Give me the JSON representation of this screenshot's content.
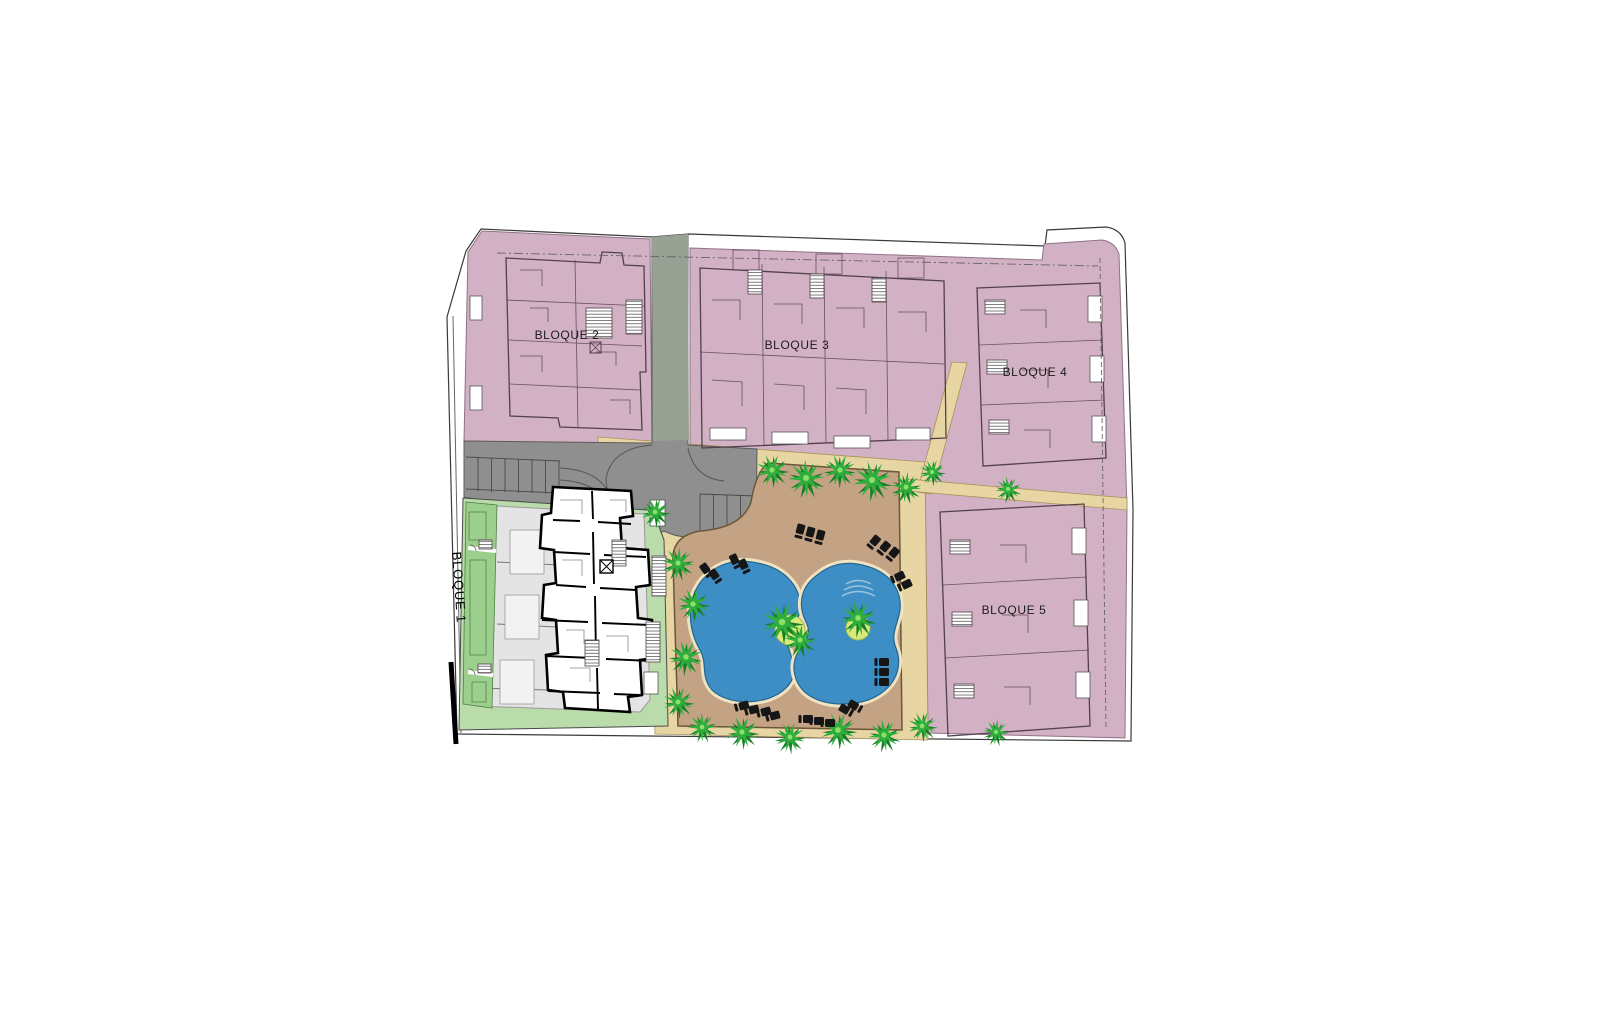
{
  "document": {
    "kind": "architectural-site-plan",
    "background": "#ffffff"
  },
  "labels": {
    "bloque1": "BLOQUE 1",
    "bloque2": "BLOQUE 2",
    "bloque3": "BLOQUE 3",
    "bloque4": "BLOQUE 4",
    "bloque5": "BLOQUE 5"
  },
  "features": {
    "pools": 2,
    "icon_names": [
      "palm-tree-icon",
      "sun-lounger-icon",
      "stair-hatch-icon",
      "elevator-x-icon"
    ],
    "areas": [
      "pink residential parcels",
      "gray road and parking",
      "sand pedestrian paths",
      "pool deck garden",
      "green private gardens",
      "white Bloque 1 floor plan"
    ]
  },
  "palette": {
    "parcel-pink": "#d3b1c4",
    "parcel-outline": "#8f7286",
    "plan-line": "#53404d",
    "road-gray": "#8f8f8f",
    "road-sage": "#97a294",
    "road-edge": "#5c5c5c",
    "sand": "#e7d6a4",
    "sand-edge": "#a89258",
    "deck": "#c3a384",
    "deck-edge": "#6b5738",
    "pool-blue": "#3c8ec4",
    "pool-edge": "#23658f",
    "pool-rim": "#efe3c2",
    "lawn": "#b9dcaa",
    "plot-green": "#9ccf8d",
    "plot-edge": "#4f7f42",
    "terrace": "#e4e4e4",
    "terrace-edge": "#9a9a9a",
    "tree-dark": "#187f27",
    "tree-bright": "#2fae3c",
    "tree-core": "#8ce06a",
    "island-ring": "#d8e87b",
    "ink": "#1c1c1c",
    "boundary": "#3a3a3a",
    "lounger": "#161616"
  }
}
